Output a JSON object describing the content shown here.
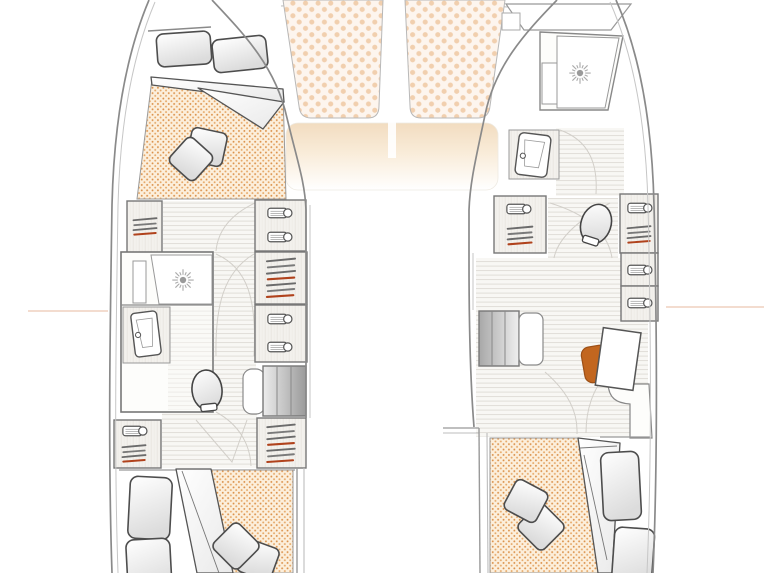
{
  "page": {
    "title": "Catamaran interior deck plan",
    "view": "top view, two hulls"
  },
  "palette": {
    "hull_line": "#8a8a8a",
    "wall_line": "#777777",
    "mattress_dot": "#db914a",
    "mattress_bg": "#fcefdc",
    "trampoline_dot": "#f1cfae",
    "trampoline_bg": "#fdf5ee",
    "chair": "#c2661f",
    "hanger_accent": "#b0421c",
    "floor_line": "#dedbd5",
    "coachroof_glow": "#f2dcc0",
    "waterline_mark": "#e8b79e"
  },
  "foredeck": {
    "label": "Foredeck",
    "port_cushion": {
      "label": "Port bow sun pad"
    },
    "starboard_cushion": {
      "label": "Starboard bow sun pad"
    },
    "coachroof": {
      "label": "Coachroof"
    }
  },
  "port_hull": {
    "label": "Port hull",
    "forward_cabin": {
      "label": "Forward double cabin",
      "berth": "Double berth",
      "pillow_count": 2,
      "cushion_count": 2
    },
    "wardrobe_forward": {
      "label": "Hanging wardrobe"
    },
    "drawer_unit_forward": {
      "label": "Drawer unit"
    },
    "hanging_locker_mid": {
      "label": "Hanging locker"
    },
    "drawer_unit_mid": {
      "label": "Drawer unit"
    },
    "bathroom": {
      "label": "Shower room",
      "shower": "Shower",
      "basin": "Washbasin",
      "toilet": "Marine toilet"
    },
    "steps": {
      "label": "Companionway steps"
    },
    "wardrobe_aft": {
      "label": "Aft wardrobe"
    },
    "hanging_locker_aft": {
      "label": "Hanging locker"
    },
    "aft_cabin": {
      "label": "Aft double cabin",
      "berth": "Double berth",
      "pillow_count": 2,
      "cushion_count": 2
    }
  },
  "starboard_hull": {
    "label": "Starboard hull",
    "bow_locker": {
      "label": "Bow locker"
    },
    "bathroom": {
      "label": "Forward shower room",
      "shower": "Shower",
      "basin": "Washbasin",
      "toilet": "Marine toilet"
    },
    "wardrobe_inboard": {
      "label": "Hanging wardrobe"
    },
    "wardrobe_outboard": {
      "label": "Hanging wardrobe"
    },
    "drawer_unit_1": {
      "label": "Drawer unit"
    },
    "drawer_unit_2": {
      "label": "Drawer unit"
    },
    "steps": {
      "label": "Companionway steps"
    },
    "office": {
      "label": "Desk area",
      "desk": "Desk",
      "chair": "Desk chair"
    },
    "aft_cabin": {
      "label": "Aft double cabin",
      "berth": "Double berth",
      "pillow_count": 2,
      "cushion_count": 2
    }
  }
}
